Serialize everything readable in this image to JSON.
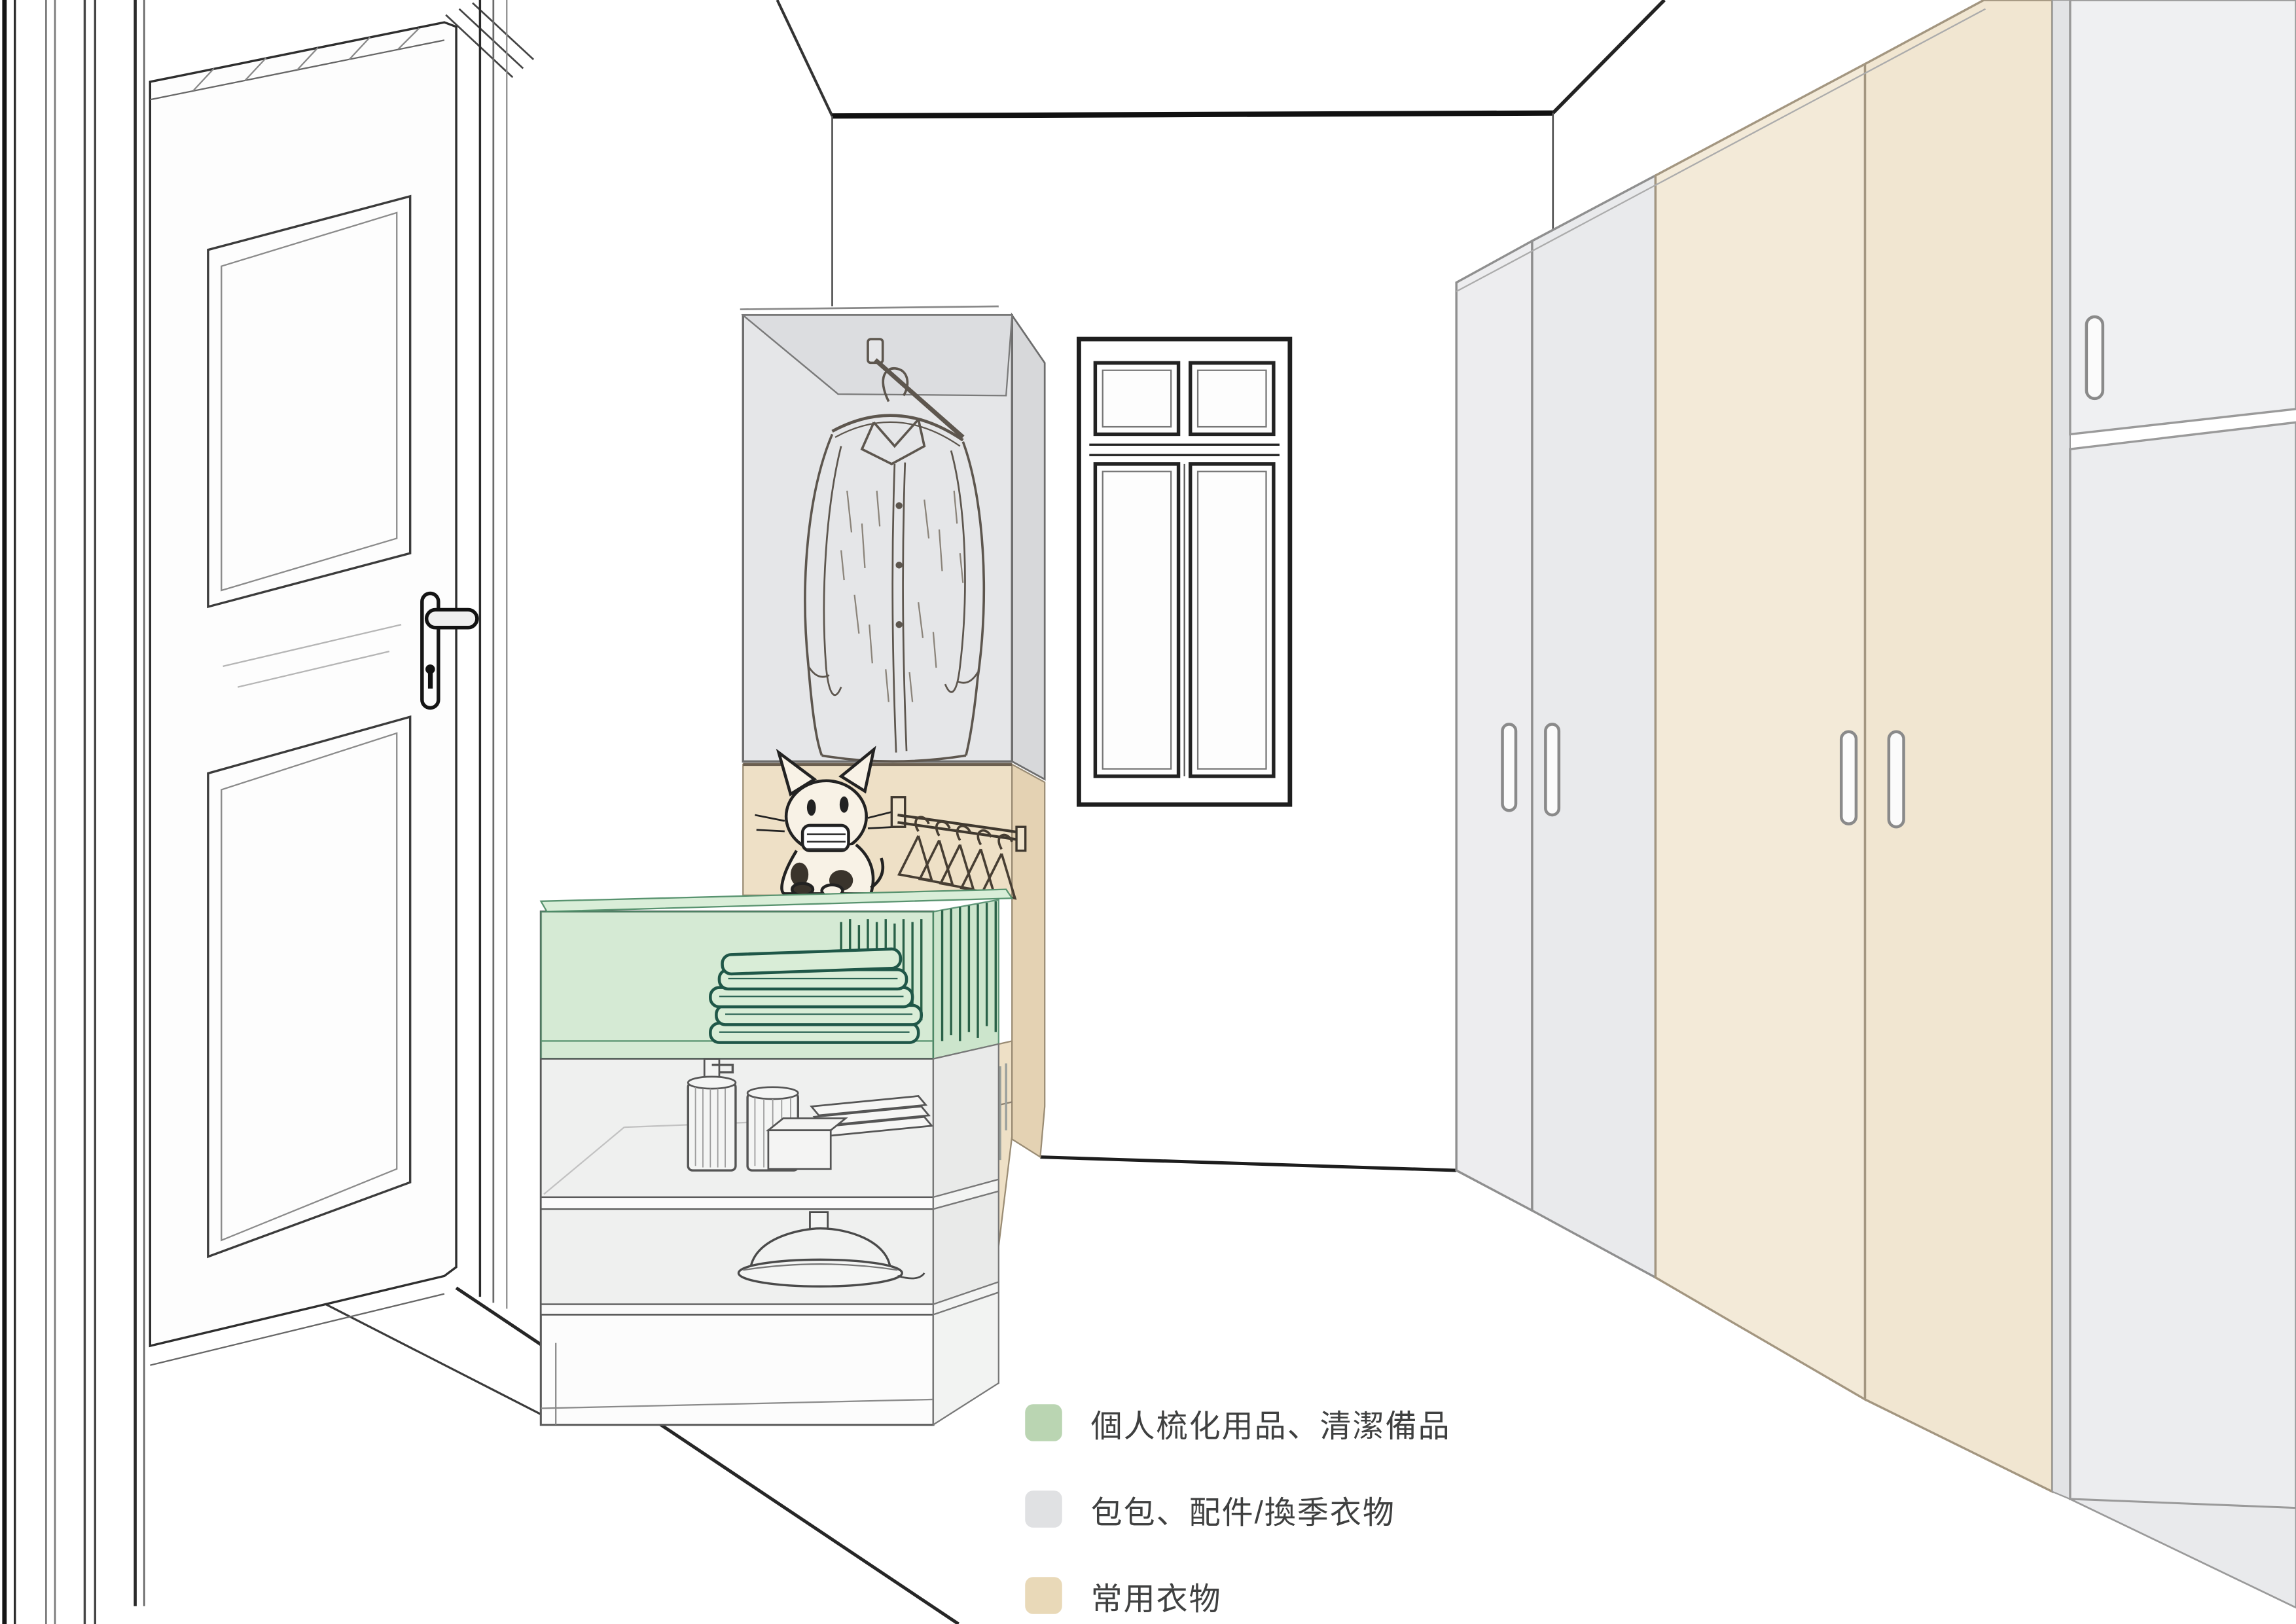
{
  "legend": {
    "items": [
      {
        "id": "personal-grooming-supplies",
        "label": "個人梳化用品、清潔備品",
        "color": "#bad5b2"
      },
      {
        "id": "bags-accessories-offseason",
        "label": "包包、配件/換季衣物",
        "color": "#e0e1e3"
      },
      {
        "id": "everyday-clothes",
        "label": "常用衣物",
        "color": "#e9d9b8"
      }
    ]
  },
  "colors": {
    "wall_line": "#1d1d1d",
    "glass_gray": "#e5e6e8",
    "glass_gray_side": "#d7d8da",
    "glass_gray_top": "#dcdde0",
    "beige_panel": "#eee0c6",
    "beige_side": "#e4d2b3",
    "green_glass": "#cde7cc",
    "green_glass_top": "#d9eed8",
    "green_glass_side": "#c6e2c5",
    "green_stroke": "#2a6148",
    "gray_door": "#ededef",
    "gray_door_alt": "#e9eaec",
    "beige_door": "#f3ead8",
    "beige_door_alt": "#f1e6d1",
    "far_unit": "#eff0f2",
    "far_unit_alt": "#ecedef",
    "cabinet_body": "#f6f7f6",
    "shelf_gray": "#eff0ef",
    "door_leaf": "#fdfdfd"
  }
}
